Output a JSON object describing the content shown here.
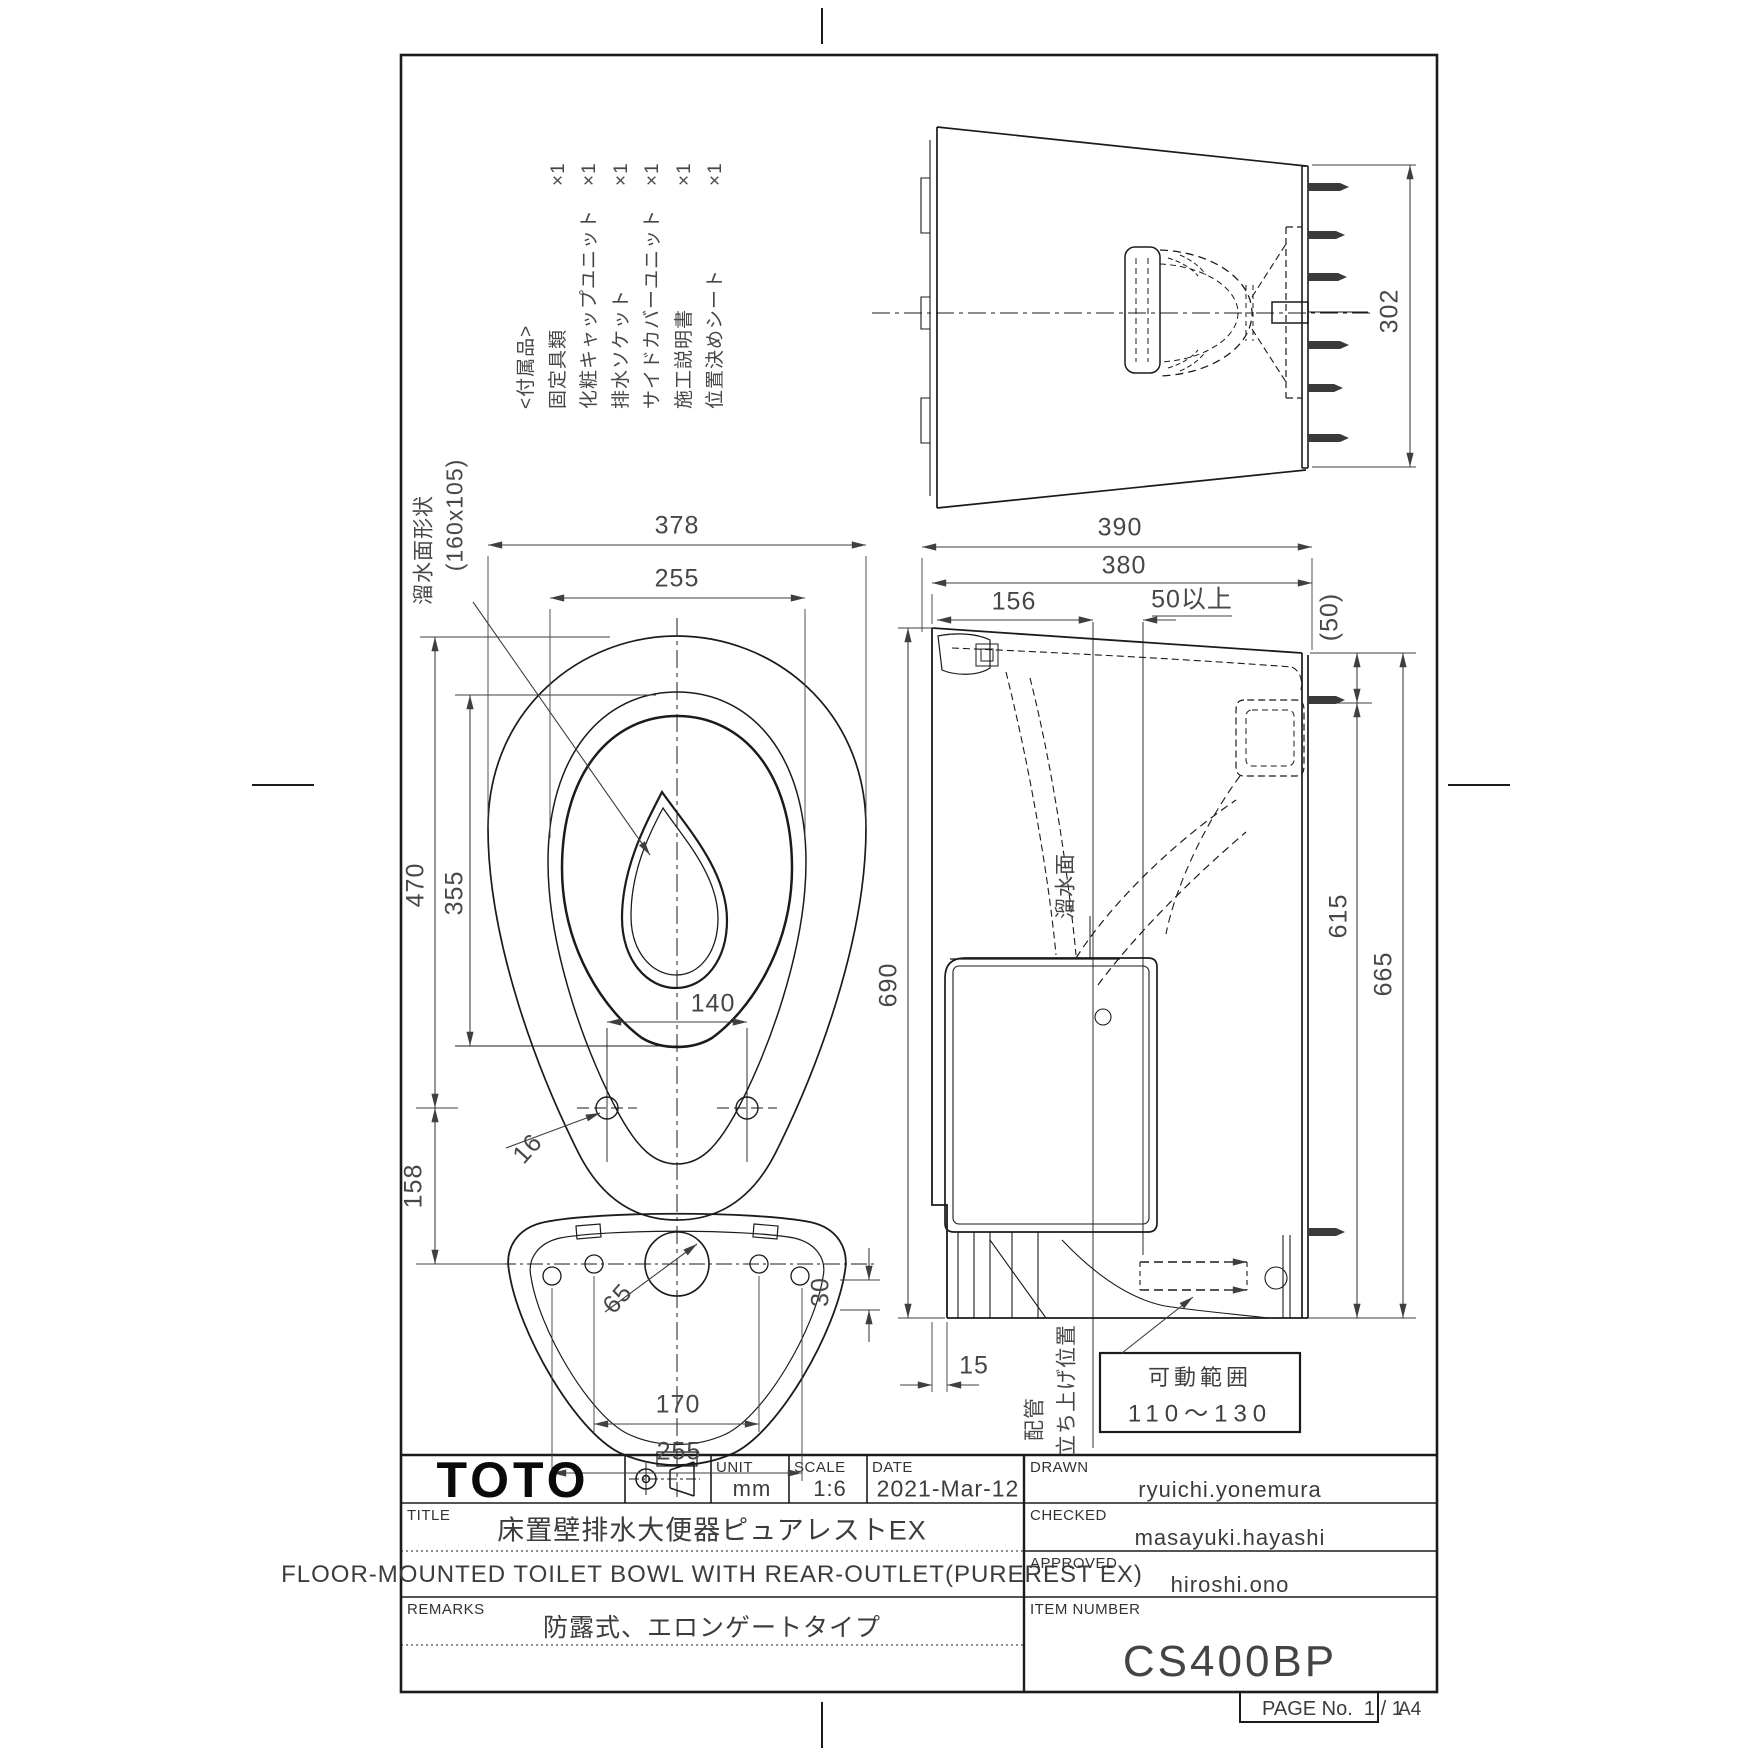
{
  "sheet": {
    "paper_size": "A4",
    "page_label": "PAGE No.",
    "page_value": "1 / 1"
  },
  "title_block": {
    "logo": "TOTO",
    "unit_label": "UNIT",
    "unit_value": "mm",
    "scale_label": "SCALE",
    "scale_value": "1:6",
    "date_label": "DATE",
    "date_value": "2021-Mar-12",
    "drawn_label": "DRAWN",
    "drawn_value": "ryuichi.yonemura",
    "checked_label": "CHECKED",
    "checked_value": "masayuki.hayashi",
    "approved_label": "APPROVED",
    "approved_value": "hiroshi.ono",
    "title_label": "TITLE",
    "title_jp": "床置壁排水大便器ピュアレストEX",
    "title_en": "FLOOR-MOUNTED TOILET BOWL WITH REAR-OUTLET(PUREREST EX)",
    "remarks_label": "REMARKS",
    "remarks_value": "防露式、エロンゲートタイプ",
    "item_number_label": "ITEM NUMBER",
    "item_number_value": "CS400BP"
  },
  "parts_list": {
    "header": "<付属品>",
    "items": [
      {
        "label": "固定具類",
        "qty": "×1"
      },
      {
        "label": "化粧キャップユニット",
        "qty": "×1"
      },
      {
        "label": "排水ソケット",
        "qty": "×1"
      },
      {
        "label": "サイドカバーユニット",
        "qty": "×1"
      },
      {
        "label": "施工説明書",
        "qty": "×1"
      },
      {
        "label": "位置決めシート",
        "qty": "×1"
      }
    ]
  },
  "movable_range": {
    "title": "可動範囲",
    "value": "110〜130"
  },
  "dim_labels": [
    {
      "name": "plan-width-378",
      "text": "378",
      "x": 677,
      "y": 526,
      "r": 0
    },
    {
      "name": "plan-rim-255",
      "text": "255",
      "x": 677,
      "y": 579,
      "r": 0
    },
    {
      "name": "plan-length-470",
      "text": "470",
      "x": 416,
      "y": 885,
      "r": -90
    },
    {
      "name": "plan-rim-length-355",
      "text": "455",
      "x": 0,
      "y": 0,
      "r": 0,
      "hide": true
    },
    {
      "name": "plan-355",
      "text": "355",
      "x": 455,
      "y": 893,
      "r": -90
    },
    {
      "name": "plan-158",
      "text": "158",
      "x": 414,
      "y": 1186,
      "r": -90
    },
    {
      "name": "plan-hole-pitch-140",
      "text": "140",
      "x": 713,
      "y": 1004,
      "r": 0
    },
    {
      "name": "plan-hole-dia-16",
      "text": "16",
      "x": 528,
      "y": 1149,
      "r": -48
    },
    {
      "name": "plan-hole-dia-65",
      "text": "65",
      "x": 618,
      "y": 1299,
      "r": -48
    },
    {
      "name": "plan-pitch-170",
      "text": "170",
      "x": 678,
      "y": 1405,
      "r": 0
    },
    {
      "name": "plan-pitch-255",
      "text": "255",
      "x": 679,
      "y": 1452,
      "r": 0
    },
    {
      "name": "plan-30",
      "text": "30",
      "x": 821,
      "y": 1292,
      "r": -90
    },
    {
      "name": "side-depth-390",
      "text": "390",
      "x": 1120,
      "y": 528,
      "r": 0
    },
    {
      "name": "side-depth-380",
      "text": "380",
      "x": 1124,
      "y": 566,
      "r": 0
    },
    {
      "name": "side-156",
      "text": "156",
      "x": 1014,
      "y": 602,
      "r": 0
    },
    {
      "name": "side-50min",
      "text": "50以上",
      "x": 1192,
      "y": 600,
      "r": 0
    },
    {
      "name": "side-50paren",
      "text": "(50)",
      "x": 1330,
      "y": 617,
      "r": -90
    },
    {
      "name": "side-615",
      "text": "615",
      "x": 1339,
      "y": 916,
      "r": -90
    },
    {
      "name": "side-665",
      "text": "665",
      "x": 1384,
      "y": 974,
      "r": -90
    },
    {
      "name": "side-height-690",
      "text": "690",
      "x": 889,
      "y": 985,
      "r": -90
    },
    {
      "name": "side-15",
      "text": "15",
      "x": 974,
      "y": 1366,
      "r": 0
    },
    {
      "name": "rear-height-302",
      "text": "302",
      "x": 1390,
      "y": 311,
      "r": -90
    },
    {
      "name": "ann-water-shape-1",
      "text": "溜水面形状",
      "x": 424,
      "y": 550,
      "r": -90,
      "fs": 21
    },
    {
      "name": "ann-water-shape-2",
      "text": "(160x105)",
      "x": 455,
      "y": 515,
      "r": -90,
      "fs": 23
    },
    {
      "name": "ann-water-surface",
      "text": "溜水面",
      "x": 1066,
      "y": 886,
      "r": -90,
      "fs": 21
    },
    {
      "name": "ann-pipe",
      "text": "配管",
      "x": 1035,
      "y": 1419,
      "r": -90,
      "fs": 21
    },
    {
      "name": "ann-pipe-riser",
      "text": "立ち上げ位置",
      "x": 1067,
      "y": 1390,
      "r": -90,
      "fs": 21
    }
  ]
}
